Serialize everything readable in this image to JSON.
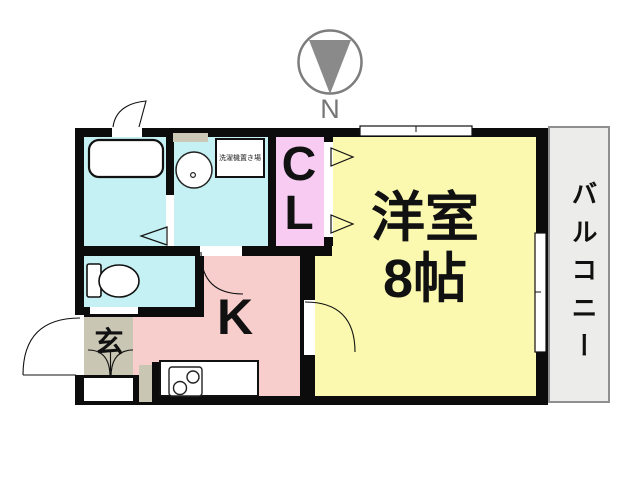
{
  "compass": {
    "north_label": "N"
  },
  "plan": {
    "western_room_label": "洋室",
    "western_room_size": "8帖",
    "kitchen_label": "K",
    "closet_line1": "C",
    "closet_line2": "L",
    "entrance_label": "玄",
    "balcony_label": "バルコニー",
    "washer_label": "洗濯機置き場"
  },
  "colors": {
    "wall": "#0c0c0c",
    "room-cyan": "#c6f1f4",
    "room-pink": "#f8cecd",
    "closet-pink": "#f7cbf2",
    "room-yellow": "#fbf8af",
    "entrance-tan": "#cac6b4",
    "vent-tan": "#ccc8b8",
    "balcony-gray": "#ececea",
    "balcony-border": "#8f8f8f",
    "compass-gray": "#8a8a8a"
  }
}
